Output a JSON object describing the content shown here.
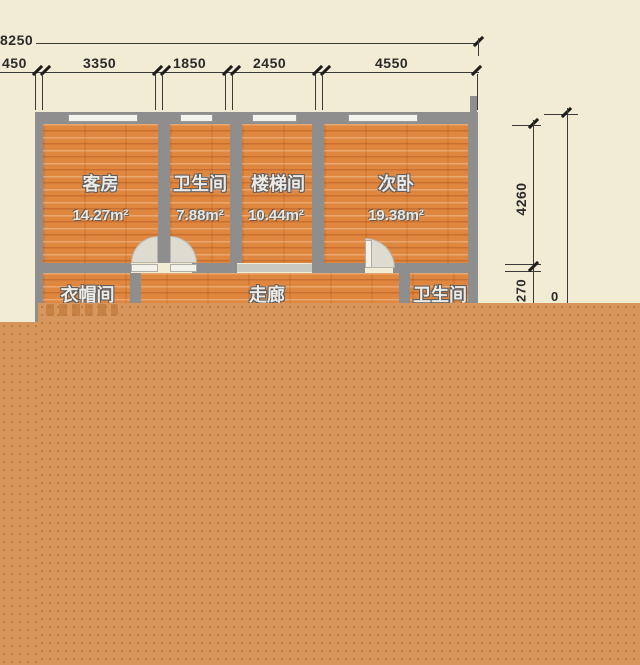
{
  "drawing": {
    "type": "floor-plan",
    "overall_width_label": "8250",
    "top_segment_labels": [
      "450",
      "3350",
      "1850",
      "2450",
      "4550"
    ],
    "right_dim_upper": "4260",
    "right_dim_lower": "270",
    "right_dim_outer_partial": "0"
  },
  "rooms": {
    "top_row": [
      {
        "name": "客房",
        "area": "14.27m²"
      },
      {
        "name": "卫生间",
        "area": "7.88m²"
      },
      {
        "name": "楼梯间",
        "area": "10.44m²"
      },
      {
        "name": "次卧",
        "area": "19.38m²"
      }
    ],
    "lower_row": [
      {
        "name": "衣帽间"
      },
      {
        "name": "走廊"
      },
      {
        "name": "卫生间"
      }
    ]
  },
  "colors": {
    "background": "#f2ecd4",
    "wall": "#8e8e8e",
    "floor_orange": "#e0873f",
    "overlay_orange": "#d6965c",
    "dim_line": "#3a3a3a",
    "label_text": "#eceae4"
  }
}
